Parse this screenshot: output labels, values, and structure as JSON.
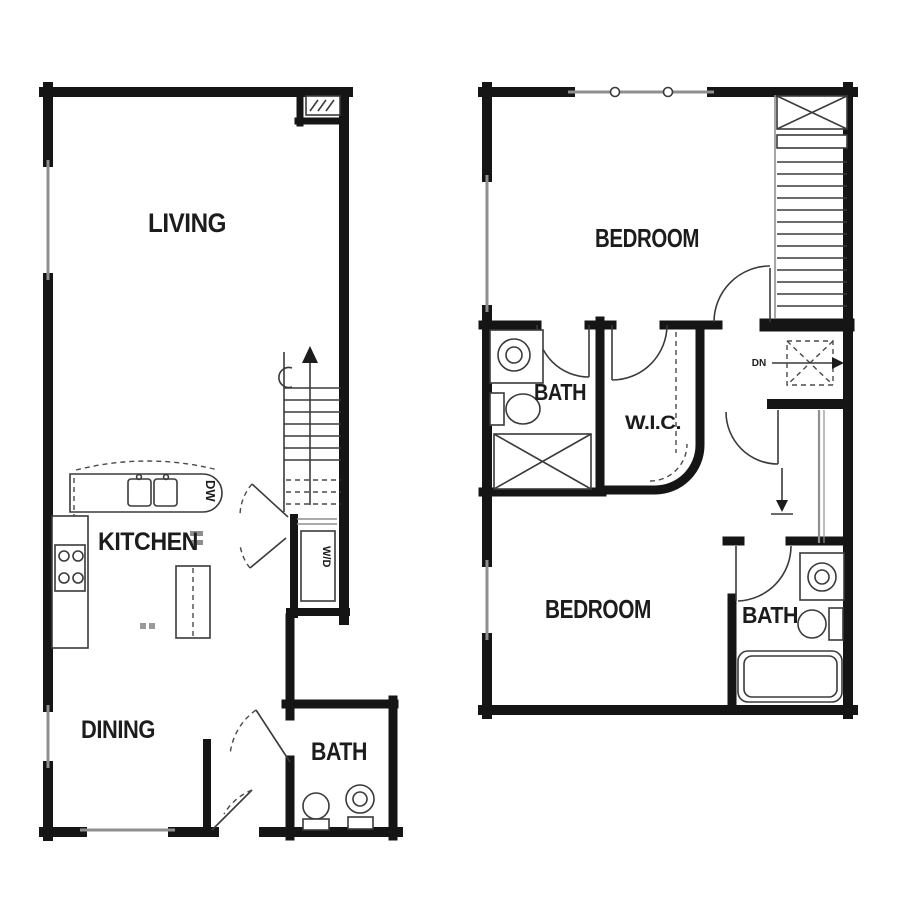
{
  "plan": {
    "type": "two-story apartment floor plan",
    "colors": {
      "wall": "#151515",
      "thin_line": "#3a3a3a",
      "window_gray": "#8f8f8f",
      "background": "#ffffff"
    }
  },
  "first_floor": {
    "rooms": {
      "living": "LIVING",
      "kitchen": "KITCHEN",
      "dining": "DINING",
      "bath": "BATH"
    },
    "labels": {
      "dishwasher": "DW",
      "washer_dryer": "W/D"
    }
  },
  "second_floor": {
    "rooms": {
      "bedroom1": "BEDROOM",
      "bath1": "BATH",
      "wic": "W.I.C.",
      "bedroom2": "BEDROOM",
      "bath2": "BATH"
    },
    "labels": {
      "down": "DN"
    }
  }
}
